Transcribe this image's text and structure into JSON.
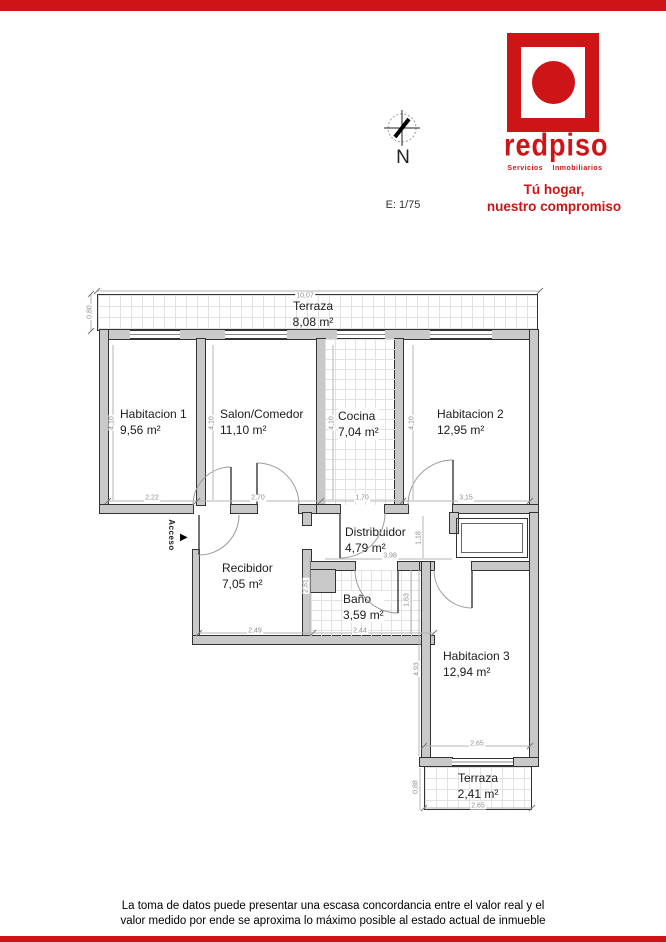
{
  "brand": {
    "logo_text": "redpiso",
    "logo_subtitle": "Servicios Inmobiliarios",
    "tagline_line1": "Tú hogar,",
    "tagline_line2": "nuestro compromiso",
    "accent_color": "#cd1417"
  },
  "compass": {
    "north_label": "N",
    "scale_label": "E: 1/75"
  },
  "access_label": "Acceso",
  "access_arrow": "▶",
  "rooms": [
    {
      "name": "Terraza",
      "area": "8,08 m²"
    },
    {
      "name": "Habitacion 1",
      "area": "9,56 m²"
    },
    {
      "name": "Salon/Comedor",
      "area": "11,10 m²"
    },
    {
      "name": "Cocina",
      "area": "7,04 m²"
    },
    {
      "name": "Habitacion 2",
      "area": "12,95 m²"
    },
    {
      "name": "Distribuidor",
      "area": "4,79 m²"
    },
    {
      "name": "Recibidor",
      "area": "7,05 m²"
    },
    {
      "name": "Baño",
      "area": "3,59 m²"
    },
    {
      "name": "Habitacion 3",
      "area": "12,94 m²"
    },
    {
      "name": "Terraza",
      "area": "2,41 m²"
    }
  ],
  "dims": [
    "10,07",
    "0,80",
    "4,10",
    "4,10",
    "4,10",
    "4,10",
    "2,22",
    "2,70",
    "1,70",
    "3,15",
    "1,18",
    "3,98",
    "2,81",
    "2,49",
    "2,44",
    "1,63",
    "4,93",
    "2,65",
    "0,88",
    "2,65"
  ],
  "disclaimer": {
    "line1": "La toma de datos puede presentar una escasa concordancia entre el valor real y el",
    "line2": "valor medido por ende se aproxima lo máximo posible al estado actual de inmueble"
  }
}
